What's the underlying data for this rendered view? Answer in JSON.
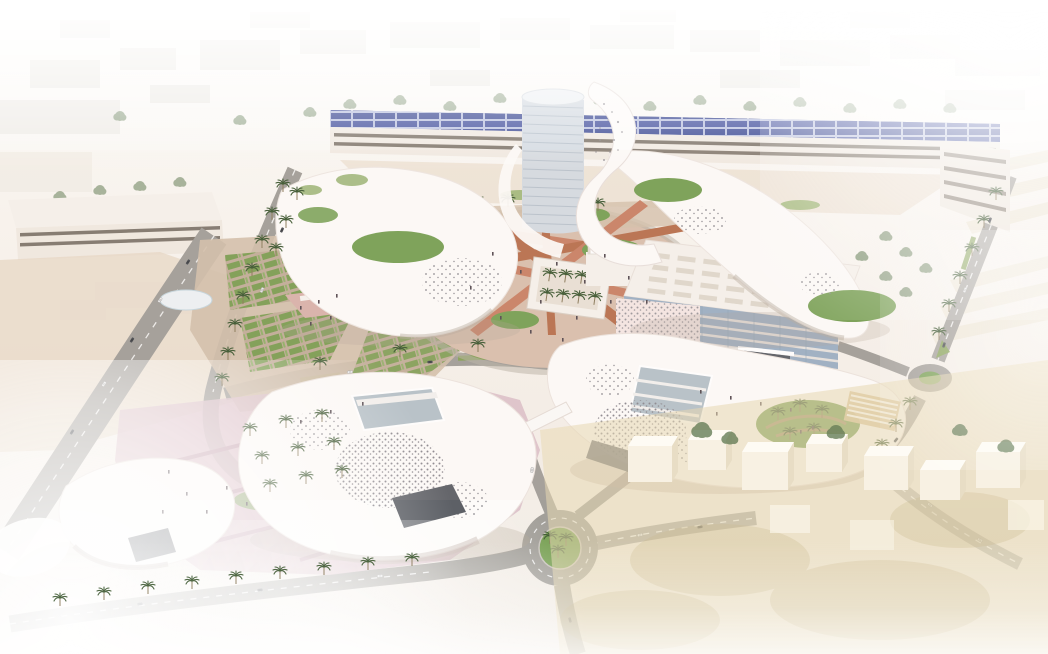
{
  "meta": {
    "type": "architectural-aerial-rendering",
    "subject": "campus-masterplan-visualization"
  },
  "scene": {
    "regions": {
      "backdrop": "hazy low-rise city context",
      "parking_structure": "long garage building with rooftop solar panels",
      "tower": "central cylindrical tower wrapped by white ribbon",
      "ring_buildings": "organic white canopy buildings encircling the central plaza",
      "central_plaza": "oval plaza with salmon radial paths, lawns, pond, shell pavilion and monument",
      "office_building": "rectangular glass building with perforated wrap facade",
      "southeast_canopy": "perforated white shell building with sunken palm courtyard",
      "southwest_canopies": "perforated white shell buildings with palm bosque plaza",
      "roads": "perimeter roads with palm rows and two roundabouts",
      "village": "white block houses fading into sand at south-east"
    }
  },
  "palette": {
    "bg_top": "#fdfcfa",
    "bg_bottom": "#f1ebe4",
    "haze": "#ffffff",
    "backdrop_block": "#eceae5",
    "canopy_white": "#fdfbf9",
    "canopy_edge": "#e9e0da",
    "canopy_shadow": "#bfb2a6",
    "perforation": "#8d8a90",
    "solar_panel": "#3d4a94",
    "garage_facade": "#f1eae2",
    "facade_stripe": "#746a5f",
    "tower_glass": "#d5dbe2",
    "tower_floor": "#b4bec9",
    "office_glass": "#9db0c4",
    "office_floor": "#e7e3df",
    "office_wrap": "#f5e7e4",
    "glass_dark": "#5d6066",
    "atrium_glass": "#b6c2c9",
    "lawn": "#79a155",
    "lawn_light": "#93b06a",
    "median_green": "#86a258",
    "palm_frond": "#3f5a33",
    "palm_trunk": "#8a7a5a",
    "tree_green": "#5f7a52",
    "plaza_ground": "#d9c0ae",
    "path_rose": "#c98266",
    "path_rose_dark": "#b8714f",
    "plaza_pink": "#d9bdc7",
    "plaza_pink_path": "#c8a7b4",
    "market_pink": "#d9b3ac",
    "garden_ground": "#d3c0ab",
    "terrace_soil": "#a98d6f",
    "road": "#a29f99",
    "sand": "#e6d6c3",
    "sand_warm": "#e7d9b2",
    "sand_shadow": "#cbb98f",
    "brick_plaza": "#c59c82",
    "block_front": "#f9f4e6",
    "block_top": "#fffef8",
    "block_side": "#e8dfc6",
    "pond": "#edf2f5",
    "pond_edge": "#bcd0da",
    "structure_white": "#f6f2ec",
    "structure_shade": "#e2d9d0",
    "people": "#574c52",
    "car_dark": "#4a4d52",
    "car_light": "#f4f4f4",
    "pergola_deck": "#d9c49a",
    "bridge_white": "#fbfaf8",
    "slab_stripe": "#6e665c"
  }
}
